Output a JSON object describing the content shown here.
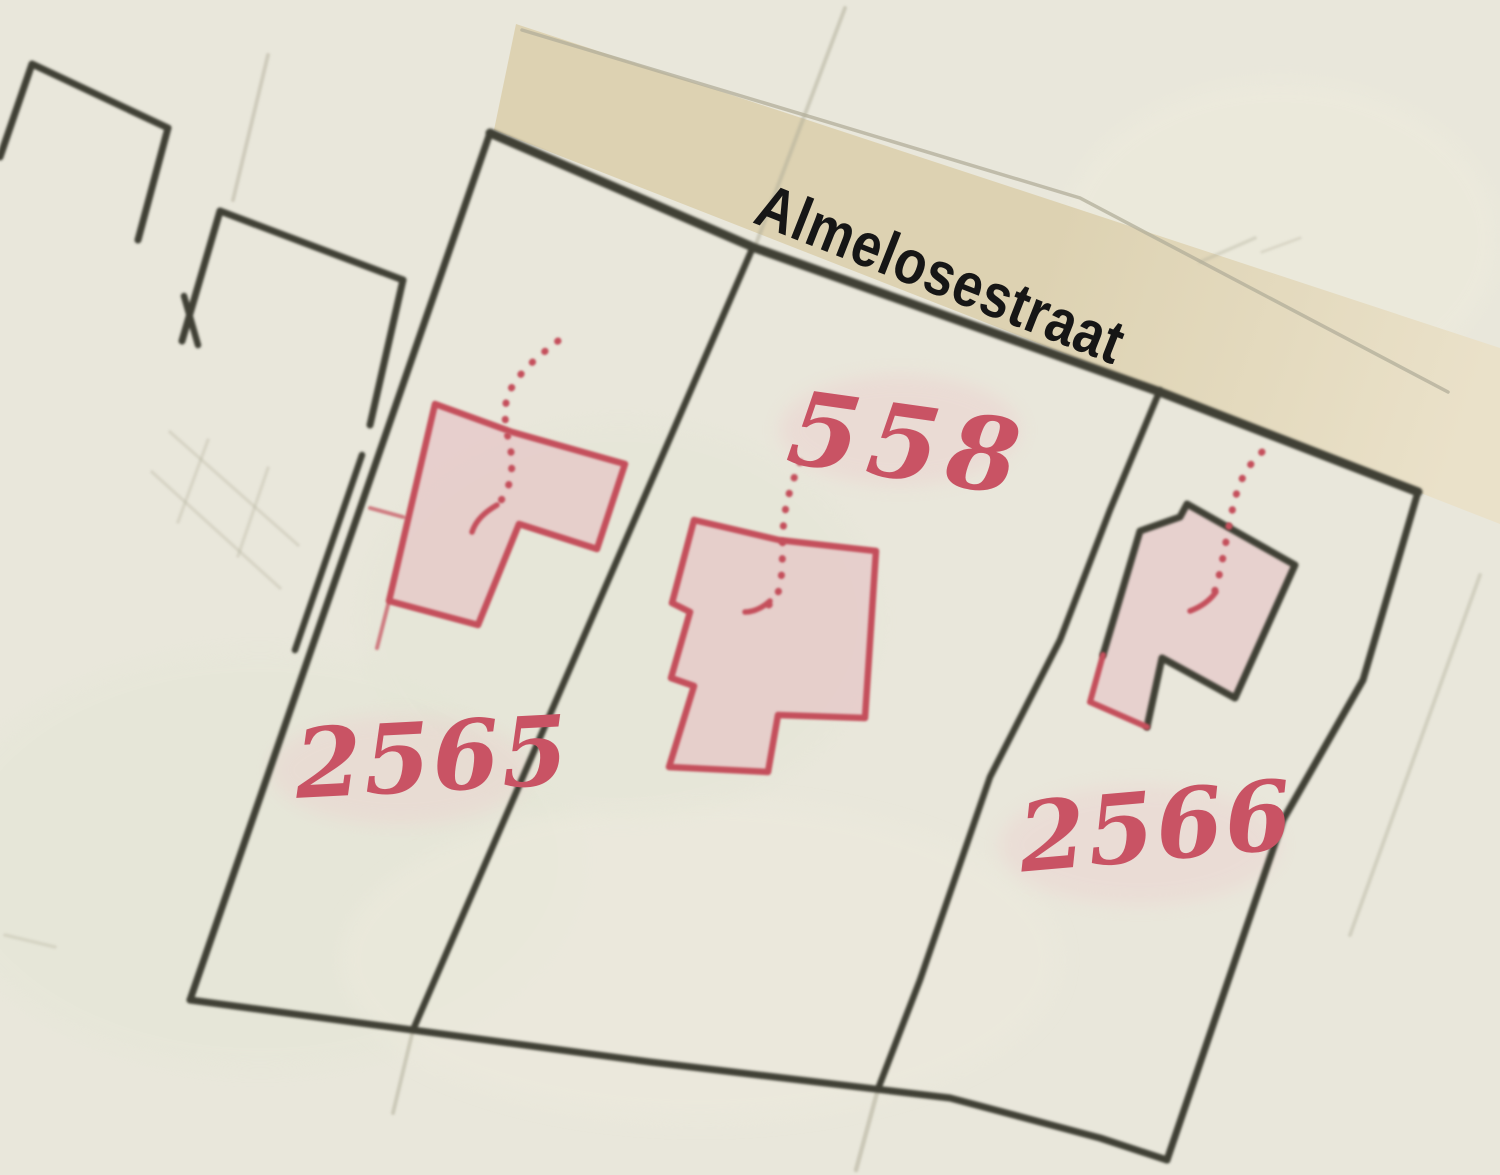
{
  "map": {
    "street_label": "Almelosestraat",
    "parcels": [
      {
        "number": "2565"
      },
      {
        "number": "558"
      },
      {
        "number": "2566"
      }
    ],
    "colors": {
      "paper": "#e9e7db",
      "street_band": "#ddd2b2",
      "street_band_light": "#eae1c9",
      "ink_dark": "#3f4036",
      "ink_red": "#c4505c",
      "building_fill": "#e6bcc1",
      "label_red": "#c95364",
      "street_text": "#161616",
      "pencil_faint": "#b2ae9a"
    }
  }
}
